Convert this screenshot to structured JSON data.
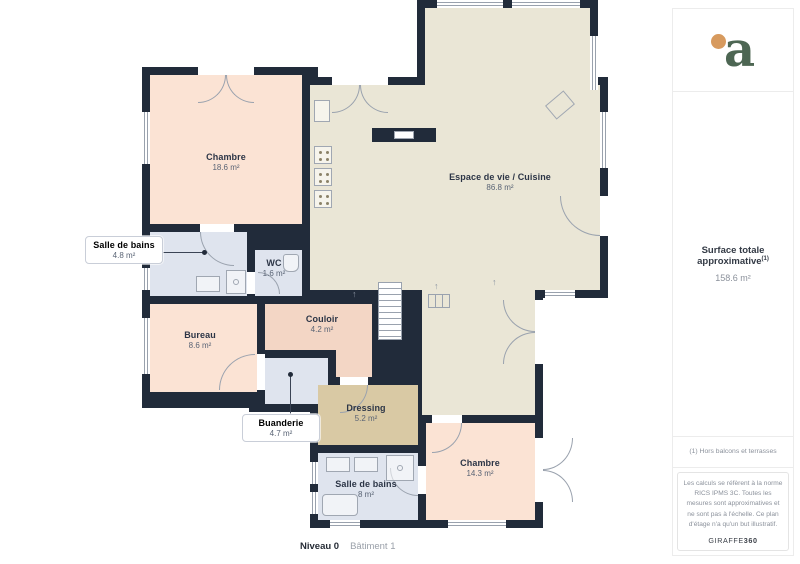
{
  "branding": {
    "logo_letter": "a",
    "logo_letter_color": "#4d6653",
    "logo_dot_color": "#d79a5e"
  },
  "sidebar": {
    "surface_title": "Surface totale approximative",
    "surface_superscript": "(1)",
    "surface_value": "158.6 m²",
    "footnote": "(1) Hors balcons et terrasses",
    "disclaimer": "Les calculs se réfèrent à la norme RICS IPMS 3C. Toutes les mesures sont approximatives et ne sont pas à l'échelle. Ce plan d'étage n'a qu'un but illustratif.",
    "brand_name": "GIRAFFE",
    "brand_number": "360"
  },
  "footer": {
    "level_label": "Niveau 0",
    "building_label": "Bâtiment 1"
  },
  "rooms": [
    {
      "name": "Chambre",
      "area": "18.6 m²"
    },
    {
      "name": "Espace de vie / Cuisine",
      "area": "86.8 m²"
    },
    {
      "name": "Salle de bains",
      "area": "4.8 m²"
    },
    {
      "name": "WC",
      "area": "1.6 m²"
    },
    {
      "name": "Couloir",
      "area": "4.2 m²"
    },
    {
      "name": "Bureau",
      "area": "8.6 m²"
    },
    {
      "name": "Buanderie",
      "area": "4.7 m²"
    },
    {
      "name": "Dressing",
      "area": "5.2 m²"
    },
    {
      "name": "Salle de bains",
      "area": "8 m²"
    },
    {
      "name": "Chambre",
      "area": "14.3 m²"
    }
  ],
  "colors": {
    "wall": "#212b3a",
    "bedroom_fill": "#fbe3d4",
    "living_fill": "#eae6d6",
    "bathroom_fill": "#dfe4ee",
    "hallway_fill": "#f3d6c5",
    "dressing_fill": "#d9c9a4"
  }
}
